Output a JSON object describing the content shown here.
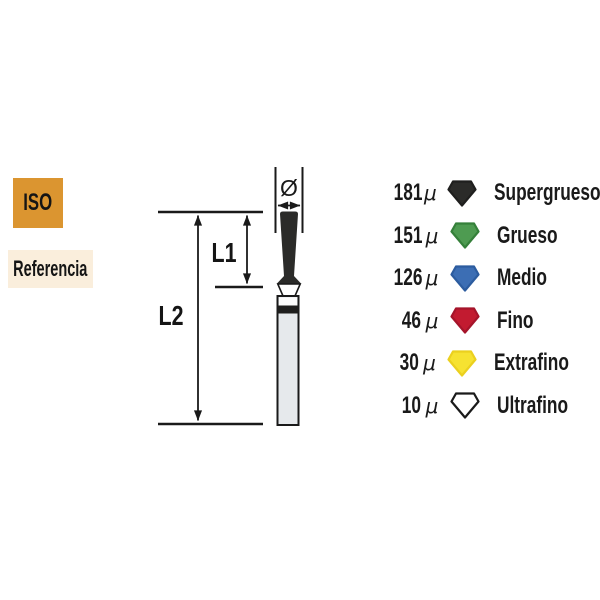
{
  "iso_box": {
    "label": "ISO",
    "bg": "#DB9530"
  },
  "referencia_box": {
    "label": "Referencia",
    "bg": "#FAEEDC"
  },
  "diagram": {
    "diameter_symbol": "Ø",
    "l1_label": "L1",
    "l2_label": "L2",
    "line_color": "#1A1A1A",
    "head_color": "#2B2B29",
    "shank_fill": "#E6E9EC",
    "band_white": "#FCFCFC",
    "band_black": "#1E1E1D"
  },
  "legend": {
    "mu": "μ",
    "rows": [
      {
        "size": "181",
        "label": "Supergrueso",
        "fill": "#2B2B29",
        "stroke": "#1F1F1E"
      },
      {
        "size": "151",
        "label": "Grueso",
        "fill": "#4E9B51",
        "stroke": "#35803A"
      },
      {
        "size": "126",
        "label": "Medio",
        "fill": "#3C6EB4",
        "stroke": "#2C5C9F"
      },
      {
        "size": "46",
        "label": "Fino",
        "fill": "#C21B30",
        "stroke": "#A5142A"
      },
      {
        "size": "30",
        "label": "Extrafino",
        "fill": "#F6E231",
        "stroke": "#EBD01F"
      },
      {
        "size": "10",
        "label": "Ultrafino",
        "fill": "#FFFFFF",
        "stroke": "#1A1A1A"
      }
    ]
  }
}
